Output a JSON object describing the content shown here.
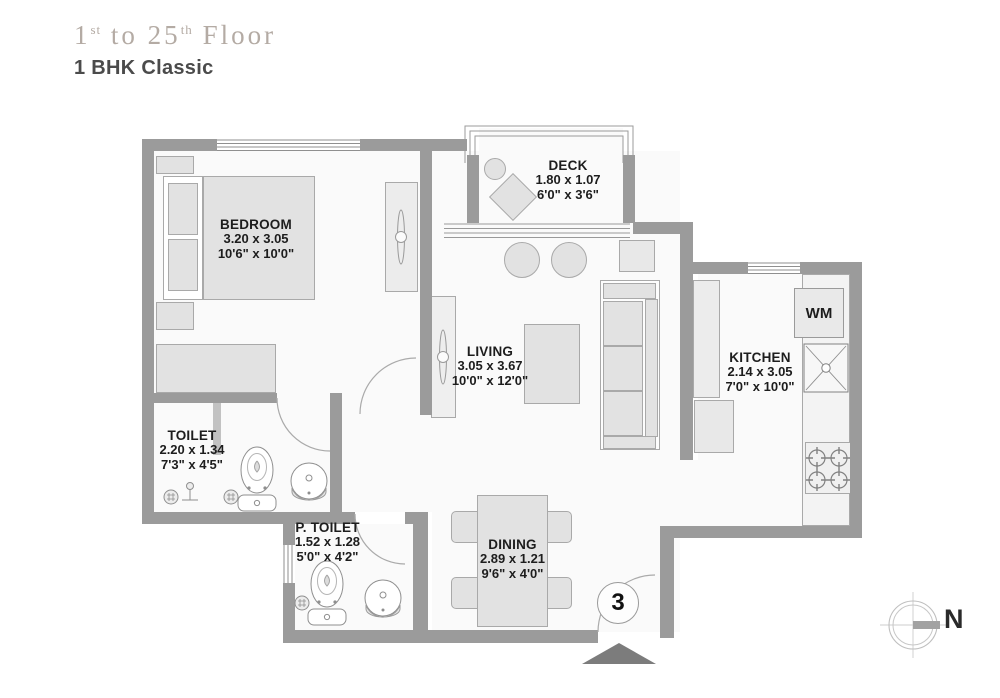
{
  "header": {
    "floor_prefix": "1",
    "floor_sup1": "st",
    "floor_mid": " to 25",
    "floor_sup2": "th",
    "floor_suffix": " Floor",
    "unit_type": "1 BHK Classic"
  },
  "rooms": {
    "bedroom": {
      "name": "BEDROOM",
      "dim_m": "3.20 x 3.05",
      "dim_ft": "10'6\" x 10'0\""
    },
    "deck": {
      "name": "DECK",
      "dim_m": "1.80 x 1.07",
      "dim_ft": "6'0\" x 3'6\""
    },
    "living": {
      "name": "LIVING",
      "dim_m": "3.05 x 3.67",
      "dim_ft": "10'0\" x 12'0\""
    },
    "kitchen": {
      "name": "KITCHEN",
      "dim_m": "2.14 x 3.05",
      "dim_ft": "7'0\" x 10'0\""
    },
    "toilet": {
      "name": "TOILET",
      "dim_m": "2.20 x 1.34",
      "dim_ft": "7'3\" x 4'5\""
    },
    "p_toilet": {
      "name": "P. TOILET",
      "dim_m": "1.52 x 1.28",
      "dim_ft": "5'0\" x 4'2\""
    },
    "dining": {
      "name": "DINING",
      "dim_m": "2.89 x 1.21",
      "dim_ft": "9'6\" x 4'0\""
    }
  },
  "appliances": {
    "washing_machine": "WM"
  },
  "markers": {
    "unit_number": "3",
    "north": "N"
  },
  "colors": {
    "wall": "#9b9b9b",
    "furniture": "#e2e2e2",
    "floor": "#fafafa",
    "title": "#b4aba4",
    "subtitle": "#4b4b4b",
    "label_text": "#1d1d1d",
    "entry_marker": "#7c7c7c"
  }
}
